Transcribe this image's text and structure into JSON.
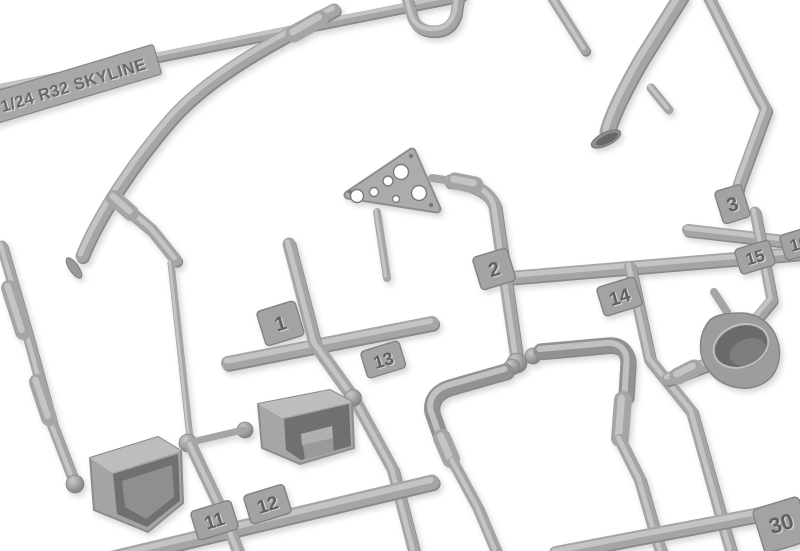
{
  "scene": {
    "type": "photograph",
    "subject": "gray plastic model kit sprue parts tree on white background",
    "background_color": "#ffffff",
    "plastic_color": "#a5a5a5",
    "plastic_highlight": "#c9c9c9",
    "plastic_shadow": "#7c7c7c",
    "embossed_text_color": "#616161"
  },
  "sprue": {
    "brand_label": "1/24 R32 SKYLINE",
    "part_tags": [
      {
        "number": "1"
      },
      {
        "number": "2"
      },
      {
        "number": "3"
      },
      {
        "number": "11"
      },
      {
        "number": "12"
      },
      {
        "number": "13"
      },
      {
        "number": "14"
      },
      {
        "number": "15"
      },
      {
        "number": "16"
      },
      {
        "number": "30"
      }
    ]
  }
}
